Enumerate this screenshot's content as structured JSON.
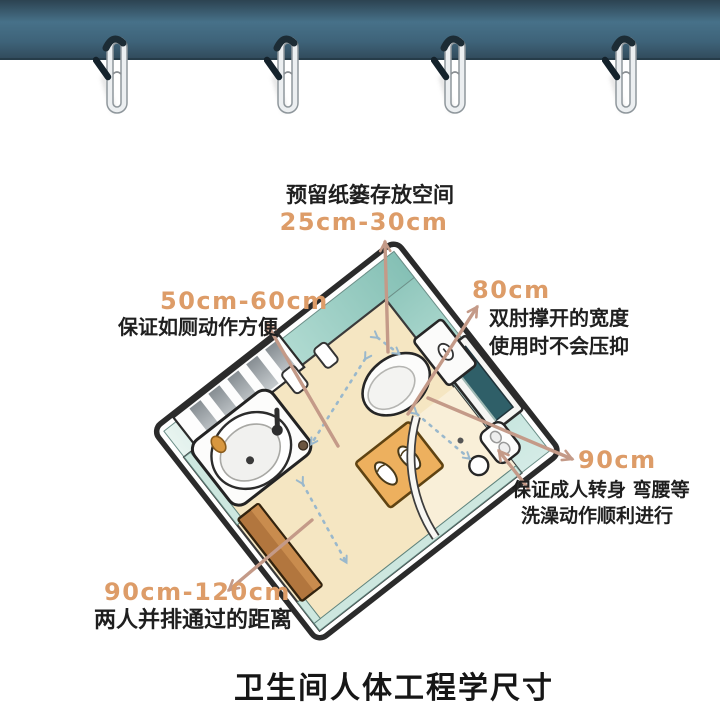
{
  "page": {
    "title": "卫生间人体工程学尺寸",
    "background_color": "#ffffff"
  },
  "curtain_rail": {
    "band_gradient": [
      "#2c4351",
      "#477189",
      "#324c5d"
    ],
    "hook_count": 4
  },
  "diagram": {
    "description": "isometric bathroom floor plan",
    "room_colors": {
      "wall_teal": "#a9d5cb",
      "floor": "#f5e6c2",
      "shower_floor": "#f9efd8",
      "outline": "#2b2b2b"
    },
    "fixture_icons": [
      "toilet-icon",
      "sink-vanity-icon",
      "wall-niche-window-icon",
      "radiator-panel-icon",
      "entry-door-icon",
      "floor-mat-slippers-icon",
      "shower-door-arc-icon",
      "corner-caddy-icon",
      "floor-roll-icon"
    ]
  },
  "annotations": {
    "paper_storage": {
      "label": "预留纸篓存放空间",
      "value": "25cm-30cm"
    },
    "toilet_clearance": {
      "value": "50cm-60cm",
      "label": "保证如厕动作方便"
    },
    "elbow_width": {
      "value": "80cm",
      "label_line1": "双肘撑开的宽度",
      "label_line2": "使用时不会压抑"
    },
    "shower_turning": {
      "value": "90cm",
      "label_line1": "保证成人转身 弯腰等",
      "label_line2": "洗澡动作顺利进行"
    },
    "passage_width": {
      "value": "90cm-120cm",
      "label": "两人并排通过的距离"
    }
  },
  "colors": {
    "annotation_value": "#dd9c68",
    "annotation_text": "#1f1f1f",
    "arrow": "#c49a88",
    "dashed_line": "#9ab8cc",
    "door": "#b2763e",
    "mat": "#edb05e"
  }
}
